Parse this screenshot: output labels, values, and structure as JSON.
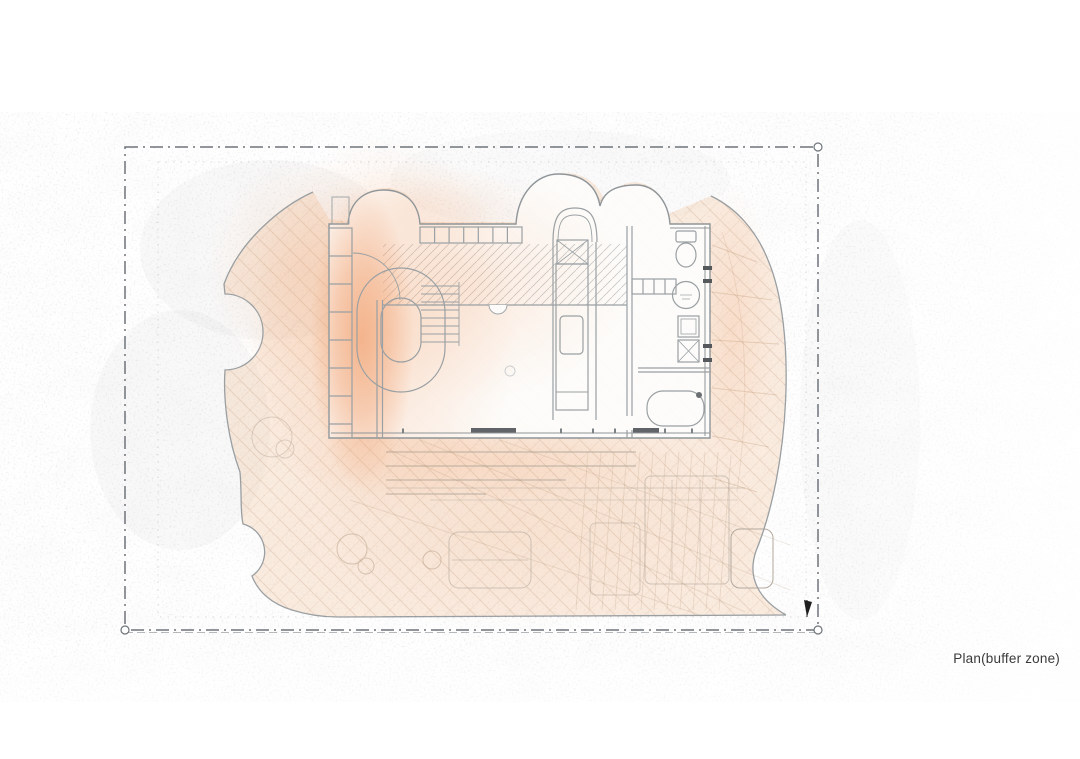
{
  "caption": {
    "label": "Plan(buffer zone)"
  },
  "colors": {
    "paper": "#ffffff",
    "buffer_hot": "#ed8345",
    "buffer_warm": "#f3a877",
    "buffer_light": "#f4c6a4",
    "deck_tint": "#f2c9ab",
    "hatch": "#a97c54",
    "linework": "#8f9598",
    "linework_dark": "#55595c",
    "boundary": "#6e747a",
    "marker": "#1f1f1f",
    "caption_text": "#3a3a3a"
  }
}
